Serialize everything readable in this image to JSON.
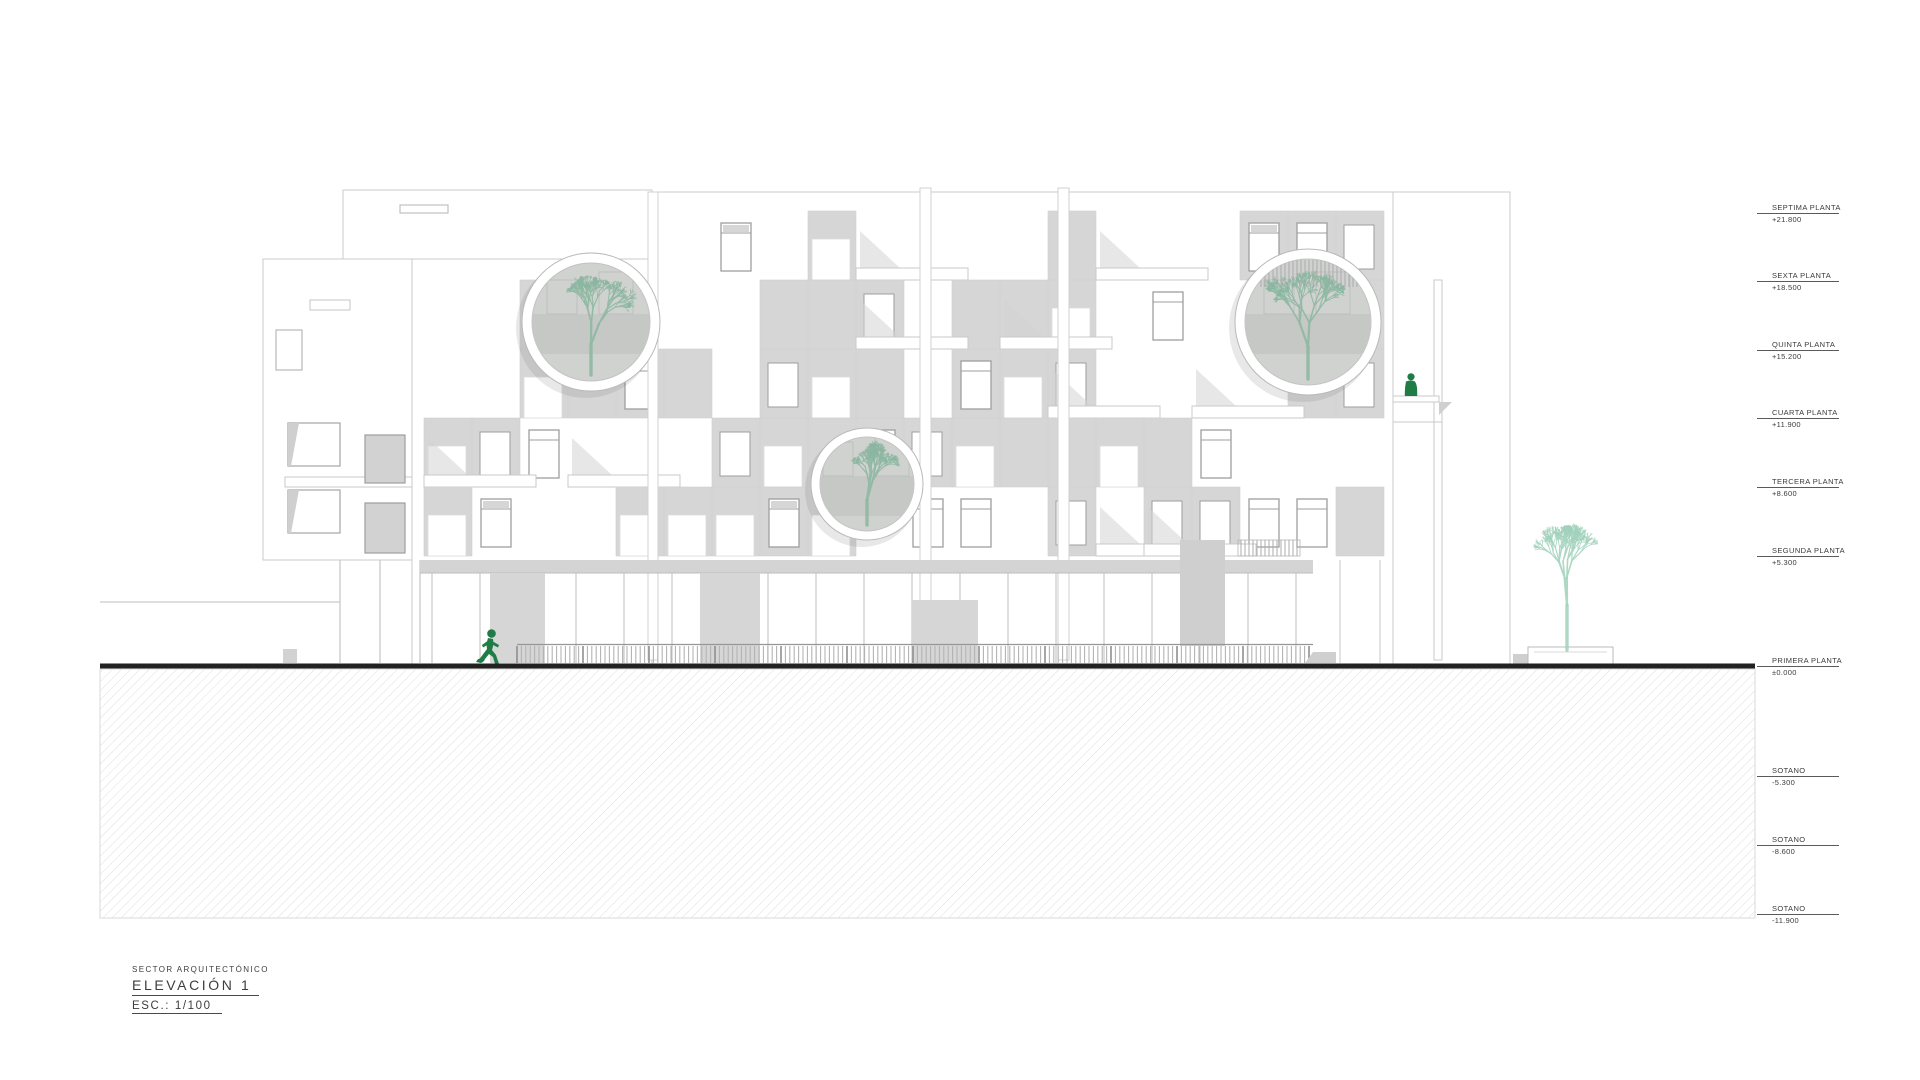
{
  "document": {
    "sector_label": "SECTOR ARQUITECTÓNICO",
    "title": "ELEVACIÓN 1",
    "scale_label": "ESC.: 1/100"
  },
  "levels": [
    {
      "label": "SEPTIMA PLANTA",
      "value": "+21.800",
      "elevation_m": 21.8
    },
    {
      "label": "SEXTA PLANTA",
      "value": "+18.500",
      "elevation_m": 18.5
    },
    {
      "label": "QUINTA PLANTA",
      "value": "+15.200",
      "elevation_m": 15.2
    },
    {
      "label": "CUARTA PLANTA",
      "value": "+11.900",
      "elevation_m": 11.9
    },
    {
      "label": "TERCERA PLANTA",
      "value": "+8.600",
      "elevation_m": 8.6
    },
    {
      "label": "SEGUNDA PLANTA",
      "value": "+5.300",
      "elevation_m": 5.3
    },
    {
      "label": "PRIMERA PLANTA",
      "value": "±0.000",
      "elevation_m": 0
    },
    {
      "label": "SOTANO",
      "value": "-5.300",
      "elevation_m": -5.3
    },
    {
      "label": "SOTANO",
      "value": "-8.600",
      "elevation_m": -8.6
    },
    {
      "label": "SOTANO",
      "value": "-11.900",
      "elevation_m": -11.9
    }
  ],
  "colors": {
    "person_green": "#1e7d46",
    "courtyard_tree_green": "#8cb7a1",
    "street_tree_green": "#a2d3bc",
    "panel_gray": "#d6d6d6",
    "frame_gray": "#9e9e9e",
    "outline_gray": "#cbcbcb",
    "courtyard_gray": "#d0d2d0",
    "ground_black": "#222222",
    "hatch_gray": "#d6d6d6"
  }
}
